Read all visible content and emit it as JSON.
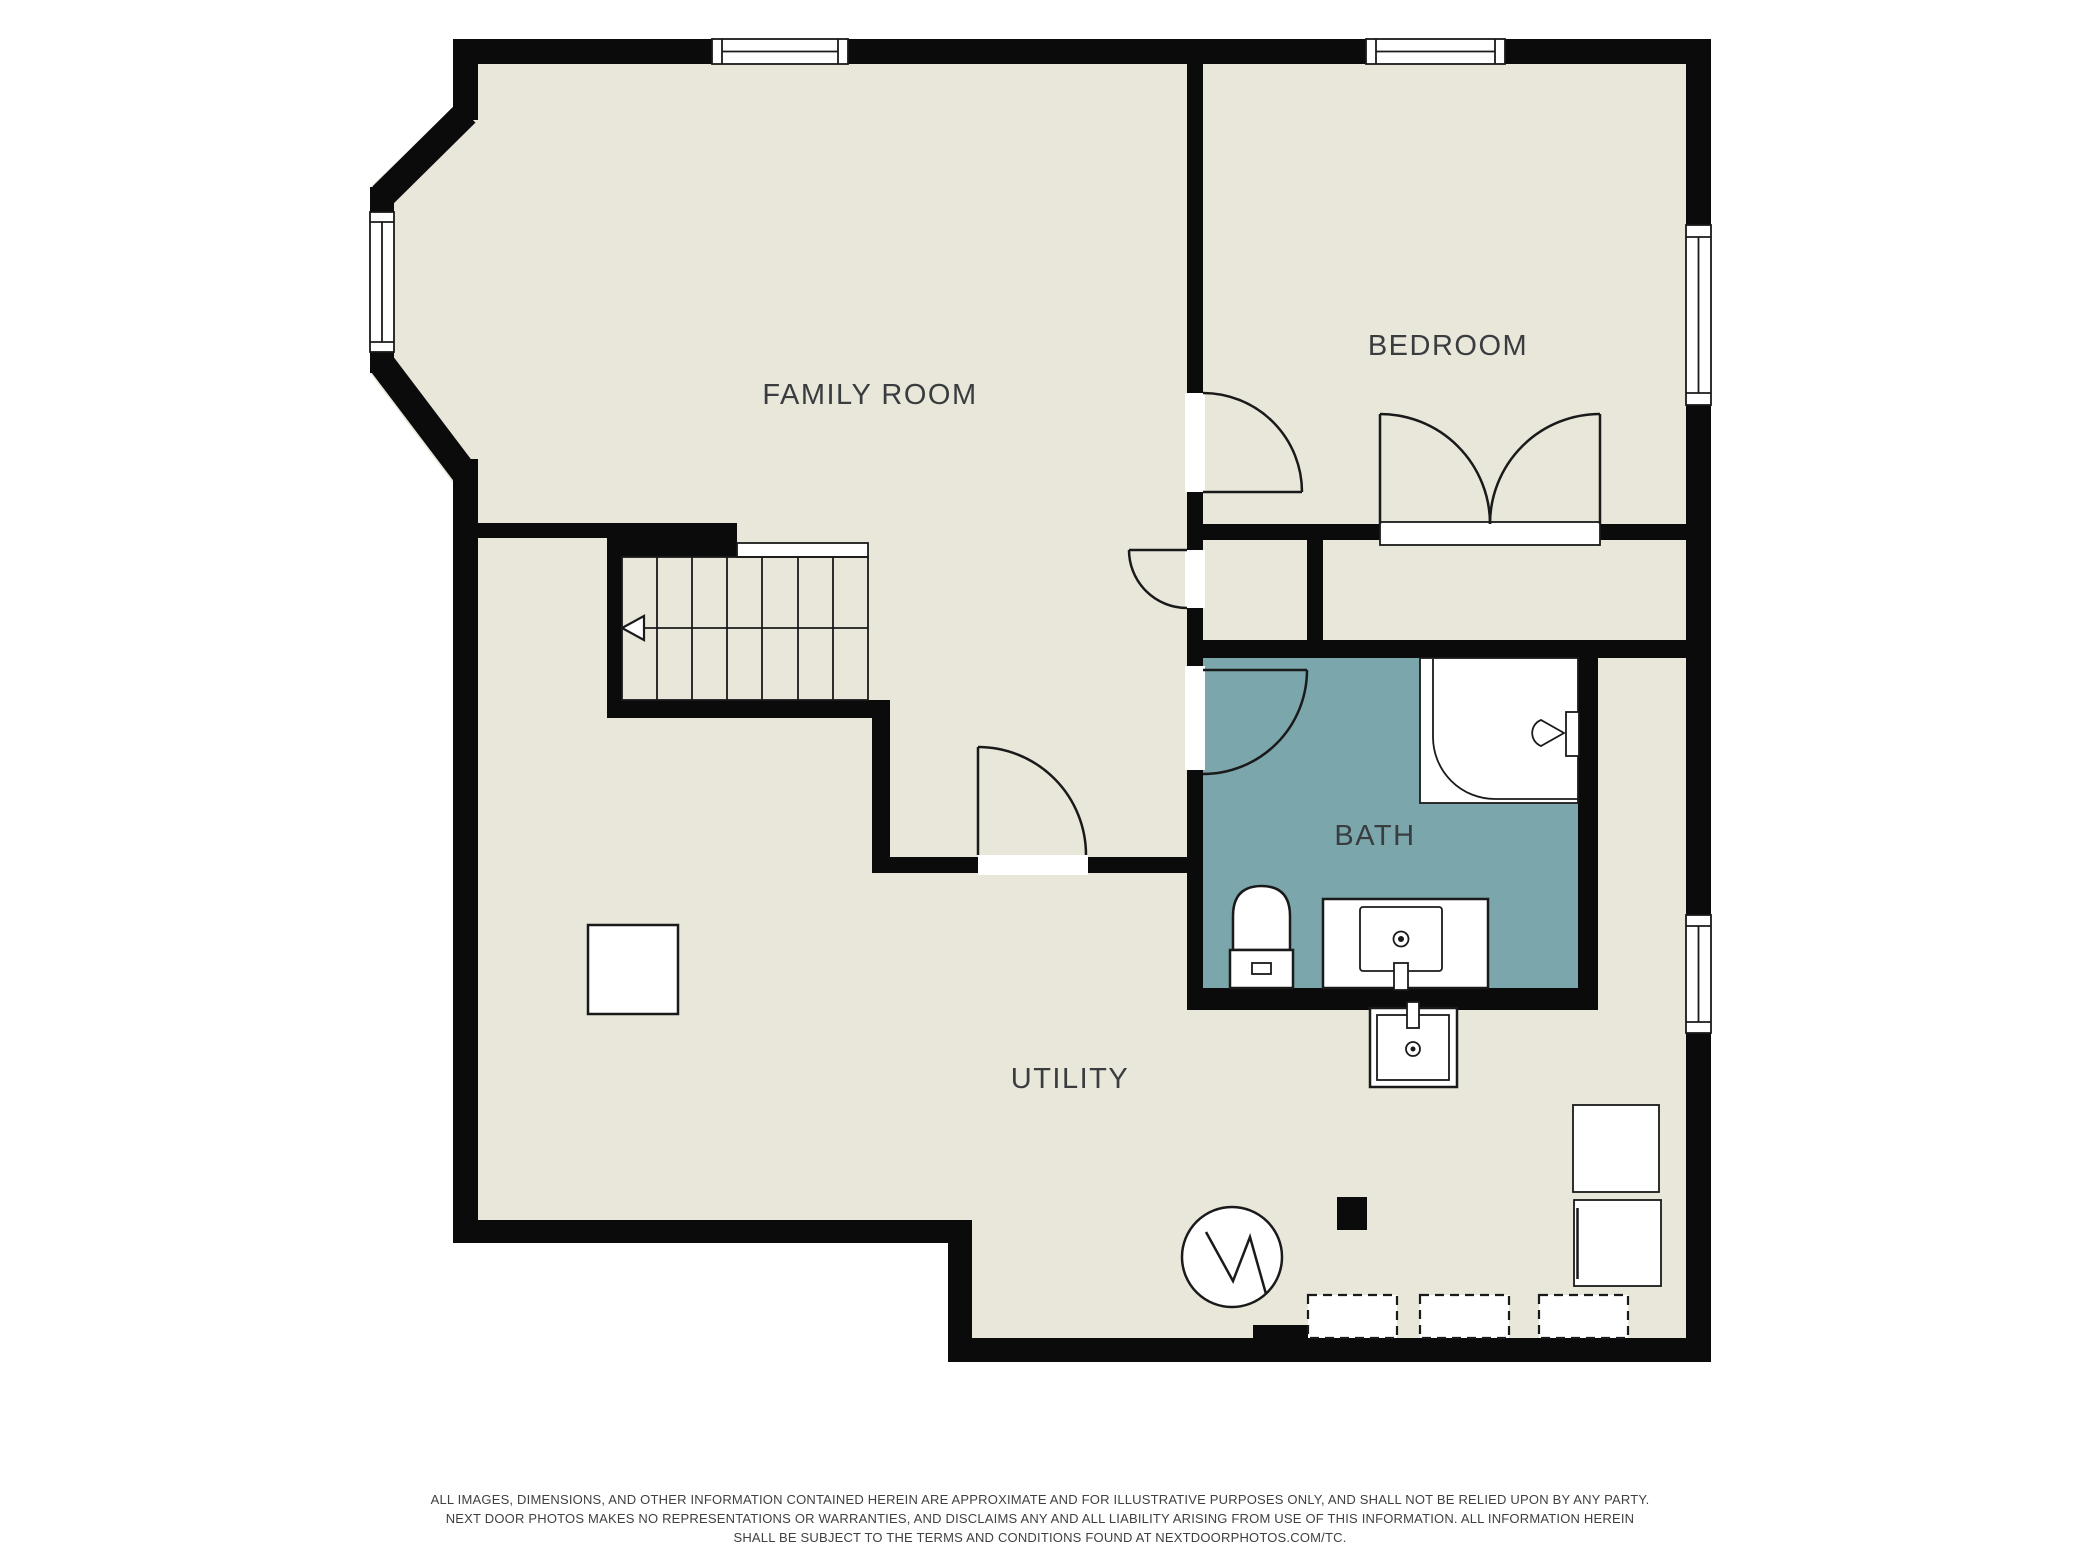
{
  "colors": {
    "background": "#ffffff",
    "wall": "#0b0b0b",
    "floor": "#e9e7da",
    "bath_floor": "#7ba6ab",
    "fixture_fill": "#ffffff",
    "label": "#3a3d3f"
  },
  "rooms": [
    {
      "id": "family-room",
      "label": "FAMILY ROOM"
    },
    {
      "id": "bedroom",
      "label": "BEDROOM"
    },
    {
      "id": "bath",
      "label": "BATH"
    },
    {
      "id": "utility",
      "label": "UTILITY"
    }
  ],
  "fixtures": [
    "stairs-with-down-arrow",
    "single-doors",
    "double-closet-doors",
    "windows",
    "corner-shower-with-showerhead",
    "toilet",
    "vanity-sink",
    "utility-sink",
    "water-heater",
    "flue",
    "support-post",
    "washer-dryer-units",
    "dashed-future-equipment-boxes"
  ],
  "disclaimer": {
    "line1": "ALL IMAGES, DIMENSIONS, AND OTHER INFORMATION CONTAINED HEREIN ARE APPROXIMATE AND FOR ILLUSTRATIVE PURPOSES ONLY, AND SHALL NOT BE RELIED UPON BY ANY PARTY.",
    "line2": "NEXT DOOR PHOTOS MAKES NO REPRESENTATIONS OR WARRANTIES, AND DISCLAIMS ANY AND ALL LIABILITY ARISING FROM USE OF THIS INFORMATION. ALL INFORMATION HEREIN",
    "line3": "SHALL BE SUBJECT TO THE TERMS AND CONDITIONS FOUND AT NEXTDOORPHOTOS.COM/TC."
  }
}
